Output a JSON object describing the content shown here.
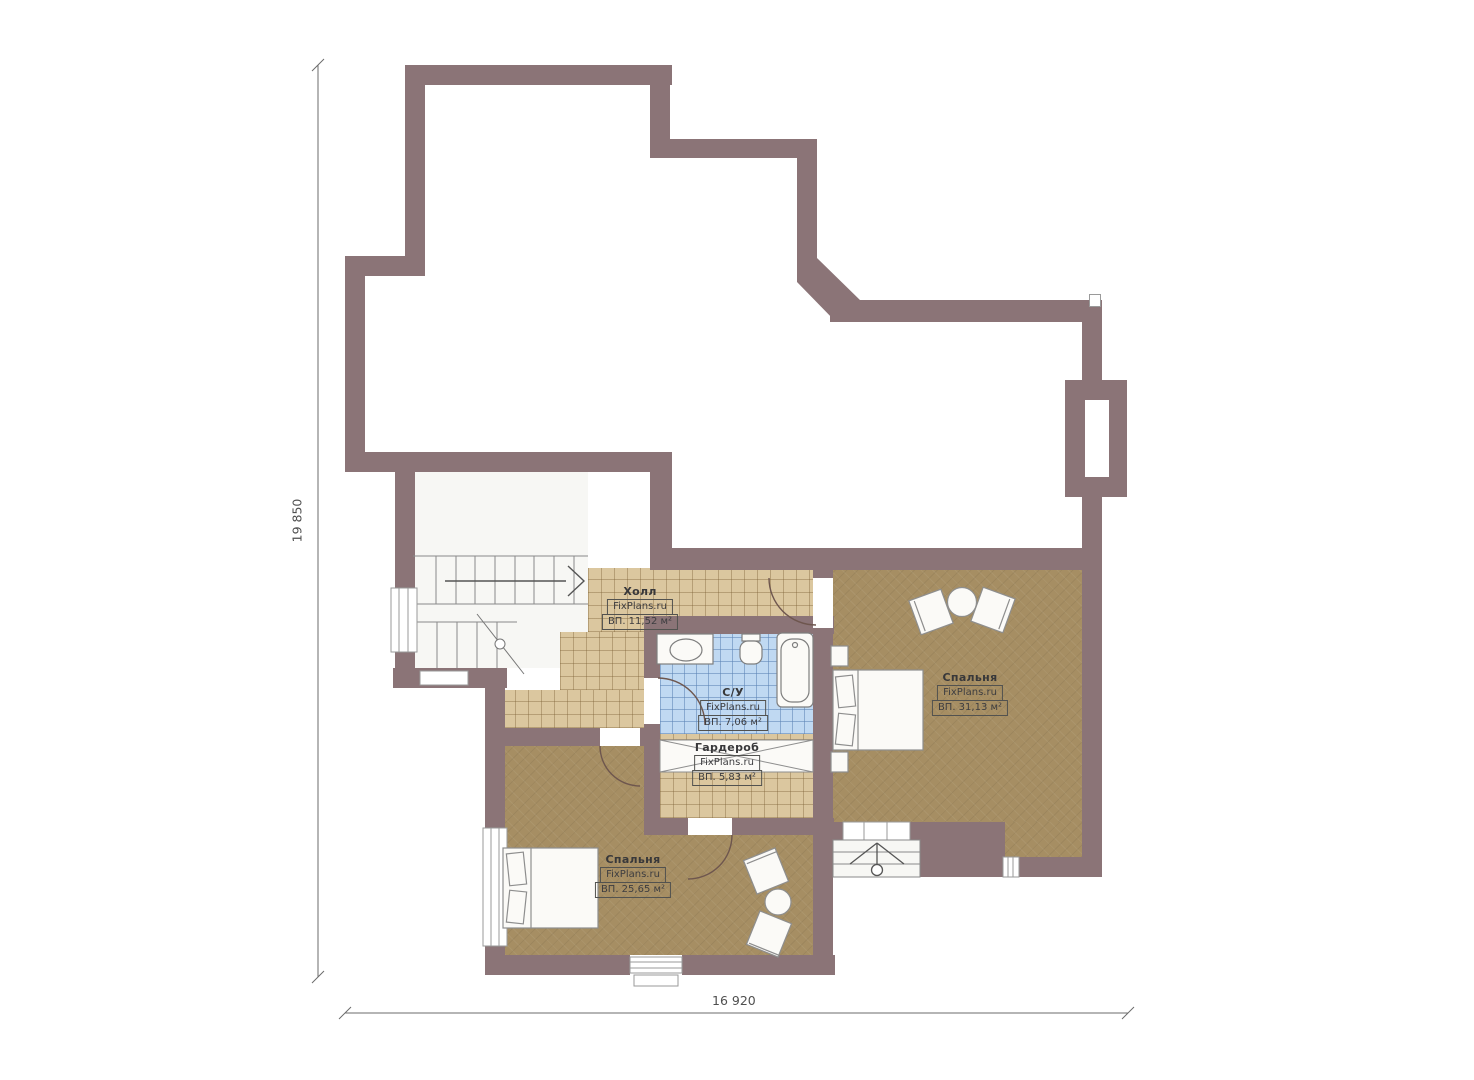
{
  "plan": {
    "title": "second-floor-plan",
    "watermark": "FixPlans.ru",
    "dimensions": {
      "left": "19 850",
      "bottom": "16 920"
    },
    "rooms": [
      {
        "name": "Холл",
        "site": "FixPlans.ru",
        "area": "ВП. 11,52 м²"
      },
      {
        "name": "С/У",
        "site": "FixPlans.ru",
        "area": "ВП. 7,06 м²"
      },
      {
        "name": "Гардероб",
        "site": "FixPlans.ru",
        "area": "ВП. 5,83 м²"
      },
      {
        "name": "Спальня",
        "site": "FixPlans.ru",
        "area": "ВП. 31,13 м²"
      },
      {
        "name": "Спальня",
        "site": "FixPlans.ru",
        "area": "ВП. 25,65 м²"
      }
    ],
    "colors": {
      "wall": "#8b7477",
      "parquet": "#dbc79f",
      "tile": "#c0d9f2",
      "wood": "#a68e63"
    }
  }
}
